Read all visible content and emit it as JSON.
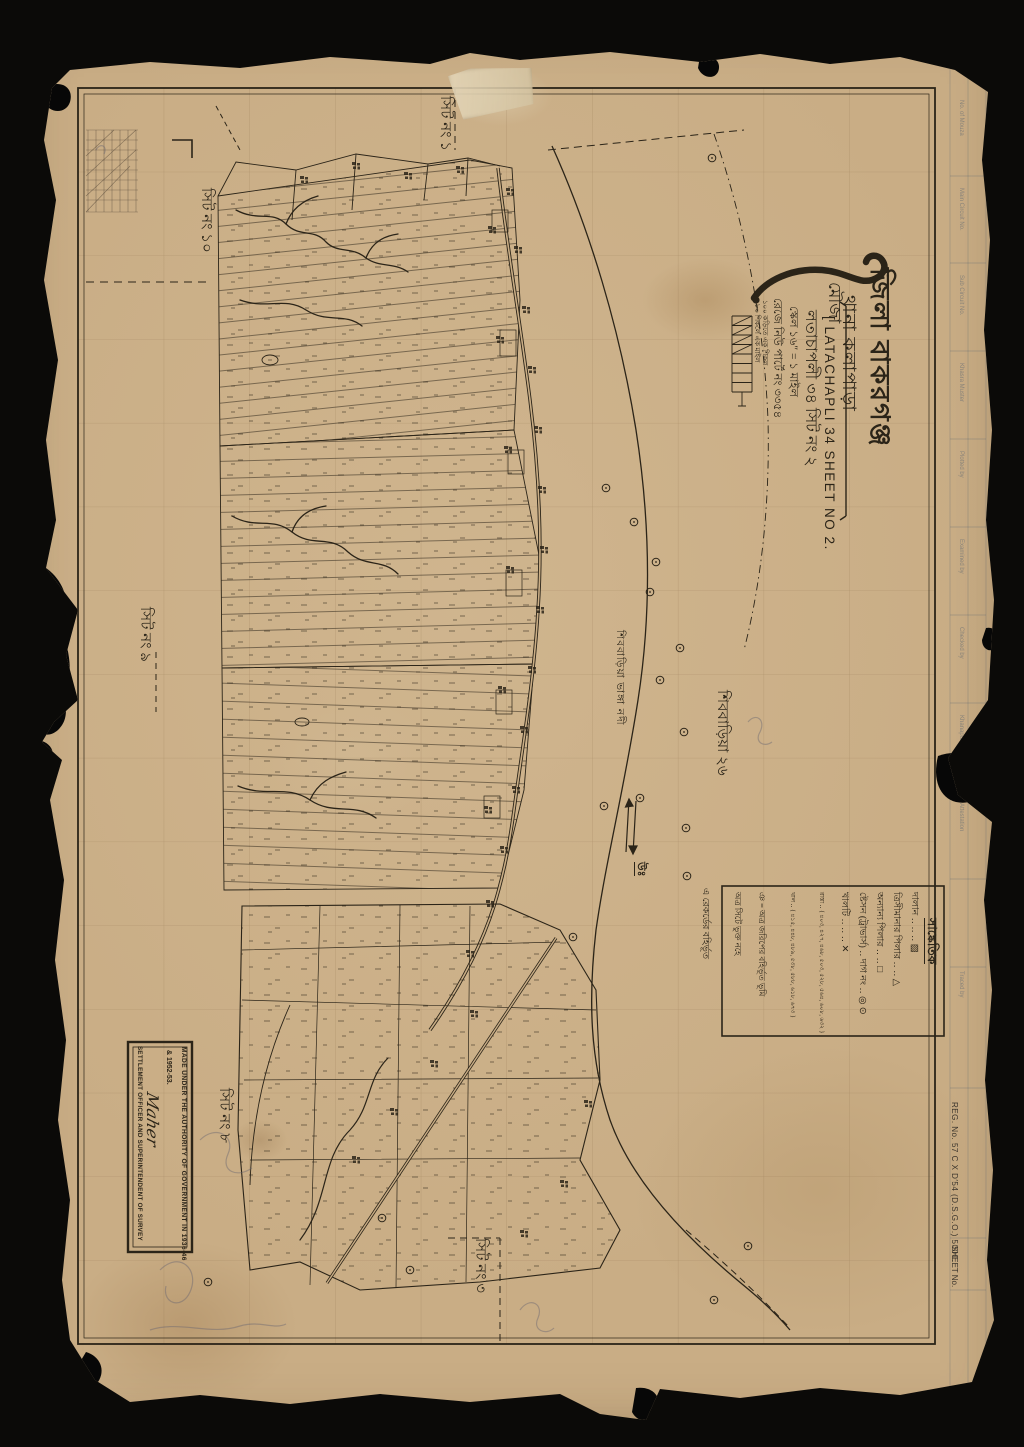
{
  "title_block": {
    "district_line": "জিলা  বাকরগঞ্জ",
    "thana_line": "থানা  কলাপাড়া",
    "mouza_label": "মৌজা",
    "mouza_en": "[ LATACHAPLI 34 SHEET NO 2.",
    "mouza_bn": "লতাচাপলী ৩৪ সিট নং ২",
    "reg_line": "রেজে নিউ পার্টে নং ৩৩৫৪",
    "scale_line": "স্কেল ১৬″ = ১ মাইল",
    "scale_note_1": "১০০ কড়িতে এক শিকল",
    "scale_note_2": "৮০ শিকলে এক মাইল"
  },
  "sheet_labels": {
    "top": "সিট নং ১",
    "left_upper": "সিট নং ১০",
    "left_lower": "সিট নং ৯",
    "bottom_left": "সিট নং ৮",
    "bottom": "সিট নং ৩"
  },
  "annotations": {
    "neighbour": "শিববাড়িয়া ২৬",
    "river": "শিববাড়িয়া ভাঙ্গা নদী",
    "north": "উঃ",
    "exclusion": "এ রেকর্ডের বহির্ভূত"
  },
  "legend": {
    "heading": "সাঙ্কেতিক",
    "rows": [
      "দালান ‥ ‥ ‥ ▨",
      "ত্রিসীমানার পিলার ‥ ‥ △",
      "অন্যান্য পিলার ‥ ‥ □",
      "ষ্টেসন (ট্রাভার্স) ‥ দাগ নং ‥ ◎ ⊙",
      "খালটি ‥ ‥ ‥ ✕",
      "রাস্তা ‥ { ৪০৩, ৪২৭, ৪৬৮, ৫০৩, ৫২৮, ৫৬৪, ৬০৮, ৬৩২ }",
      "খাল ‥ { ৪১৫, ৪৪৮, ৪৮৯, ৫৩৮, ৫৮৮, ৬১৮, ৬৭৩ }",
      "ঞ = অত্র জরিপের বহির্ভূত ভূমি",
      "অত্র সিটে ভুক্ত নহে"
    ]
  },
  "stamp": {
    "line1": "MADE UNDER THE AUTHORITY OF GOVERNMENT IN 1936-46",
    "line2": "& 1952-53.",
    "signature": "Maher",
    "line3": "SETTLEMENT OFFICER AND SUPERINTENDENT OF SURVEY"
  },
  "margin": {
    "reg_no": "REG. No. 57 C X D′54 (D.S.G.O.) 5000.",
    "sheet_no": "SHEET No.",
    "fields": [
      "No. of Mouza",
      "Main Circuit No.",
      "Sub Circuit No.",
      "Khasra Muster",
      "Plotted by",
      "Examined by",
      "Checked by",
      "Khanapuri",
      "Attestation",
      "Traced by"
    ]
  },
  "colors": {
    "paper": "#c9ad85",
    "ink": "#2b2418"
  }
}
